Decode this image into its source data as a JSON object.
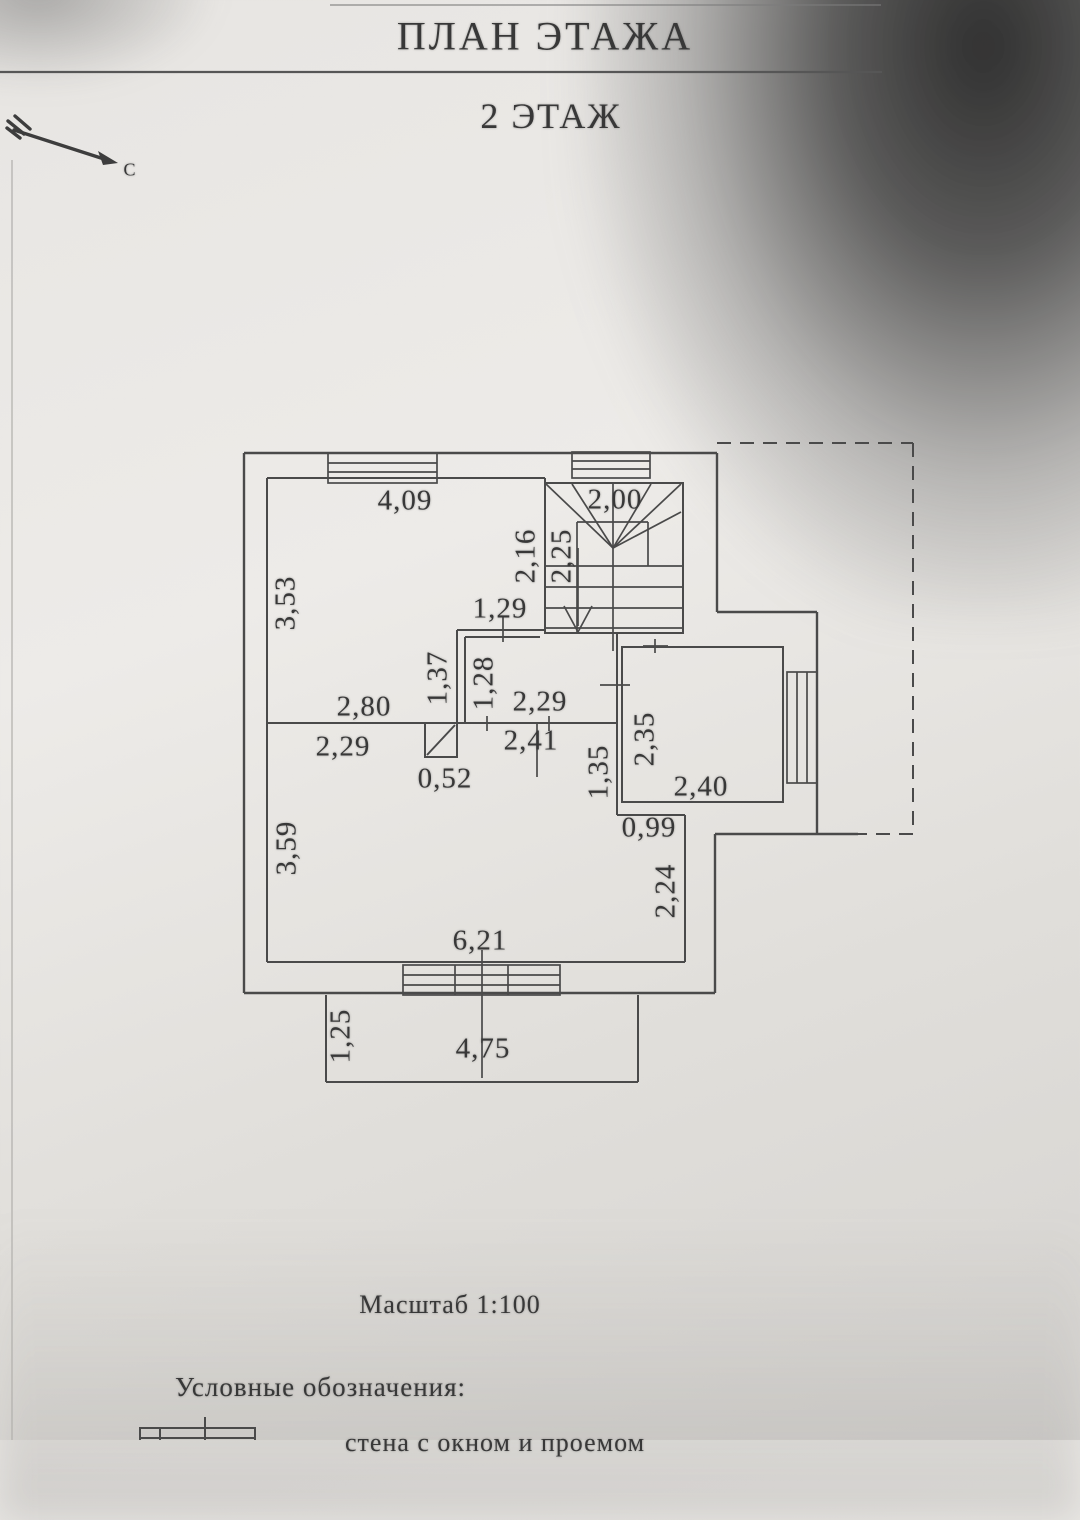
{
  "page": {
    "title": "ПЛАН ЭТАЖА",
    "subtitle": "2 ЭТАЖ",
    "scale": "Масштаб 1:100",
    "legend_heading": "Условные обозначения:",
    "legend_item_1": "стена с окном и проемом",
    "north_label": "С"
  },
  "dims": {
    "top_room_width": "4,09",
    "stair_width": "2,00",
    "top_room_left": "3,53",
    "top_room_right": "2,16",
    "stair_depth": "2,25",
    "alcove_opening": "1,29",
    "alcove_left": "1,37",
    "hall_left": "1,28",
    "hall_width": "2,29",
    "top_room_bottom": "2,80",
    "living_top_left": "2,29",
    "duct": "0,52",
    "corridor_width": "2,41",
    "partition_height": "1,35",
    "right_room_height": "2,35",
    "right_room_width": "2,40",
    "step_width": "0,99",
    "living_left": "3,59",
    "living_right": "2,24",
    "living_bottom": "6,21",
    "balcony_depth": "1,25",
    "balcony_width": "4,75"
  },
  "colors": {
    "paper": "#e9e7e4",
    "line": "#4a4a4a",
    "ink": "#383838"
  }
}
